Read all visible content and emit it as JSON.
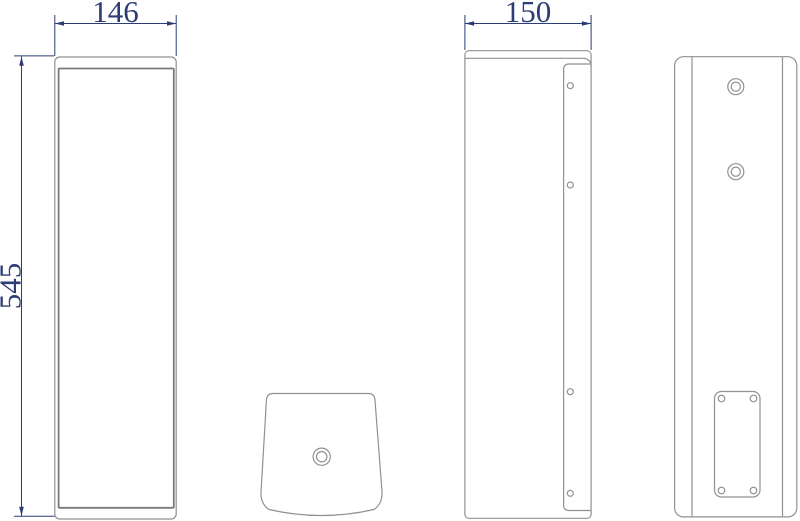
{
  "drawing": {
    "dimensions": {
      "width": "146",
      "height": "545",
      "depth": "150"
    },
    "colors": {
      "outline": "#919191",
      "outline_dark": "#7a7a7a",
      "dimension": "#2c3c74"
    }
  }
}
